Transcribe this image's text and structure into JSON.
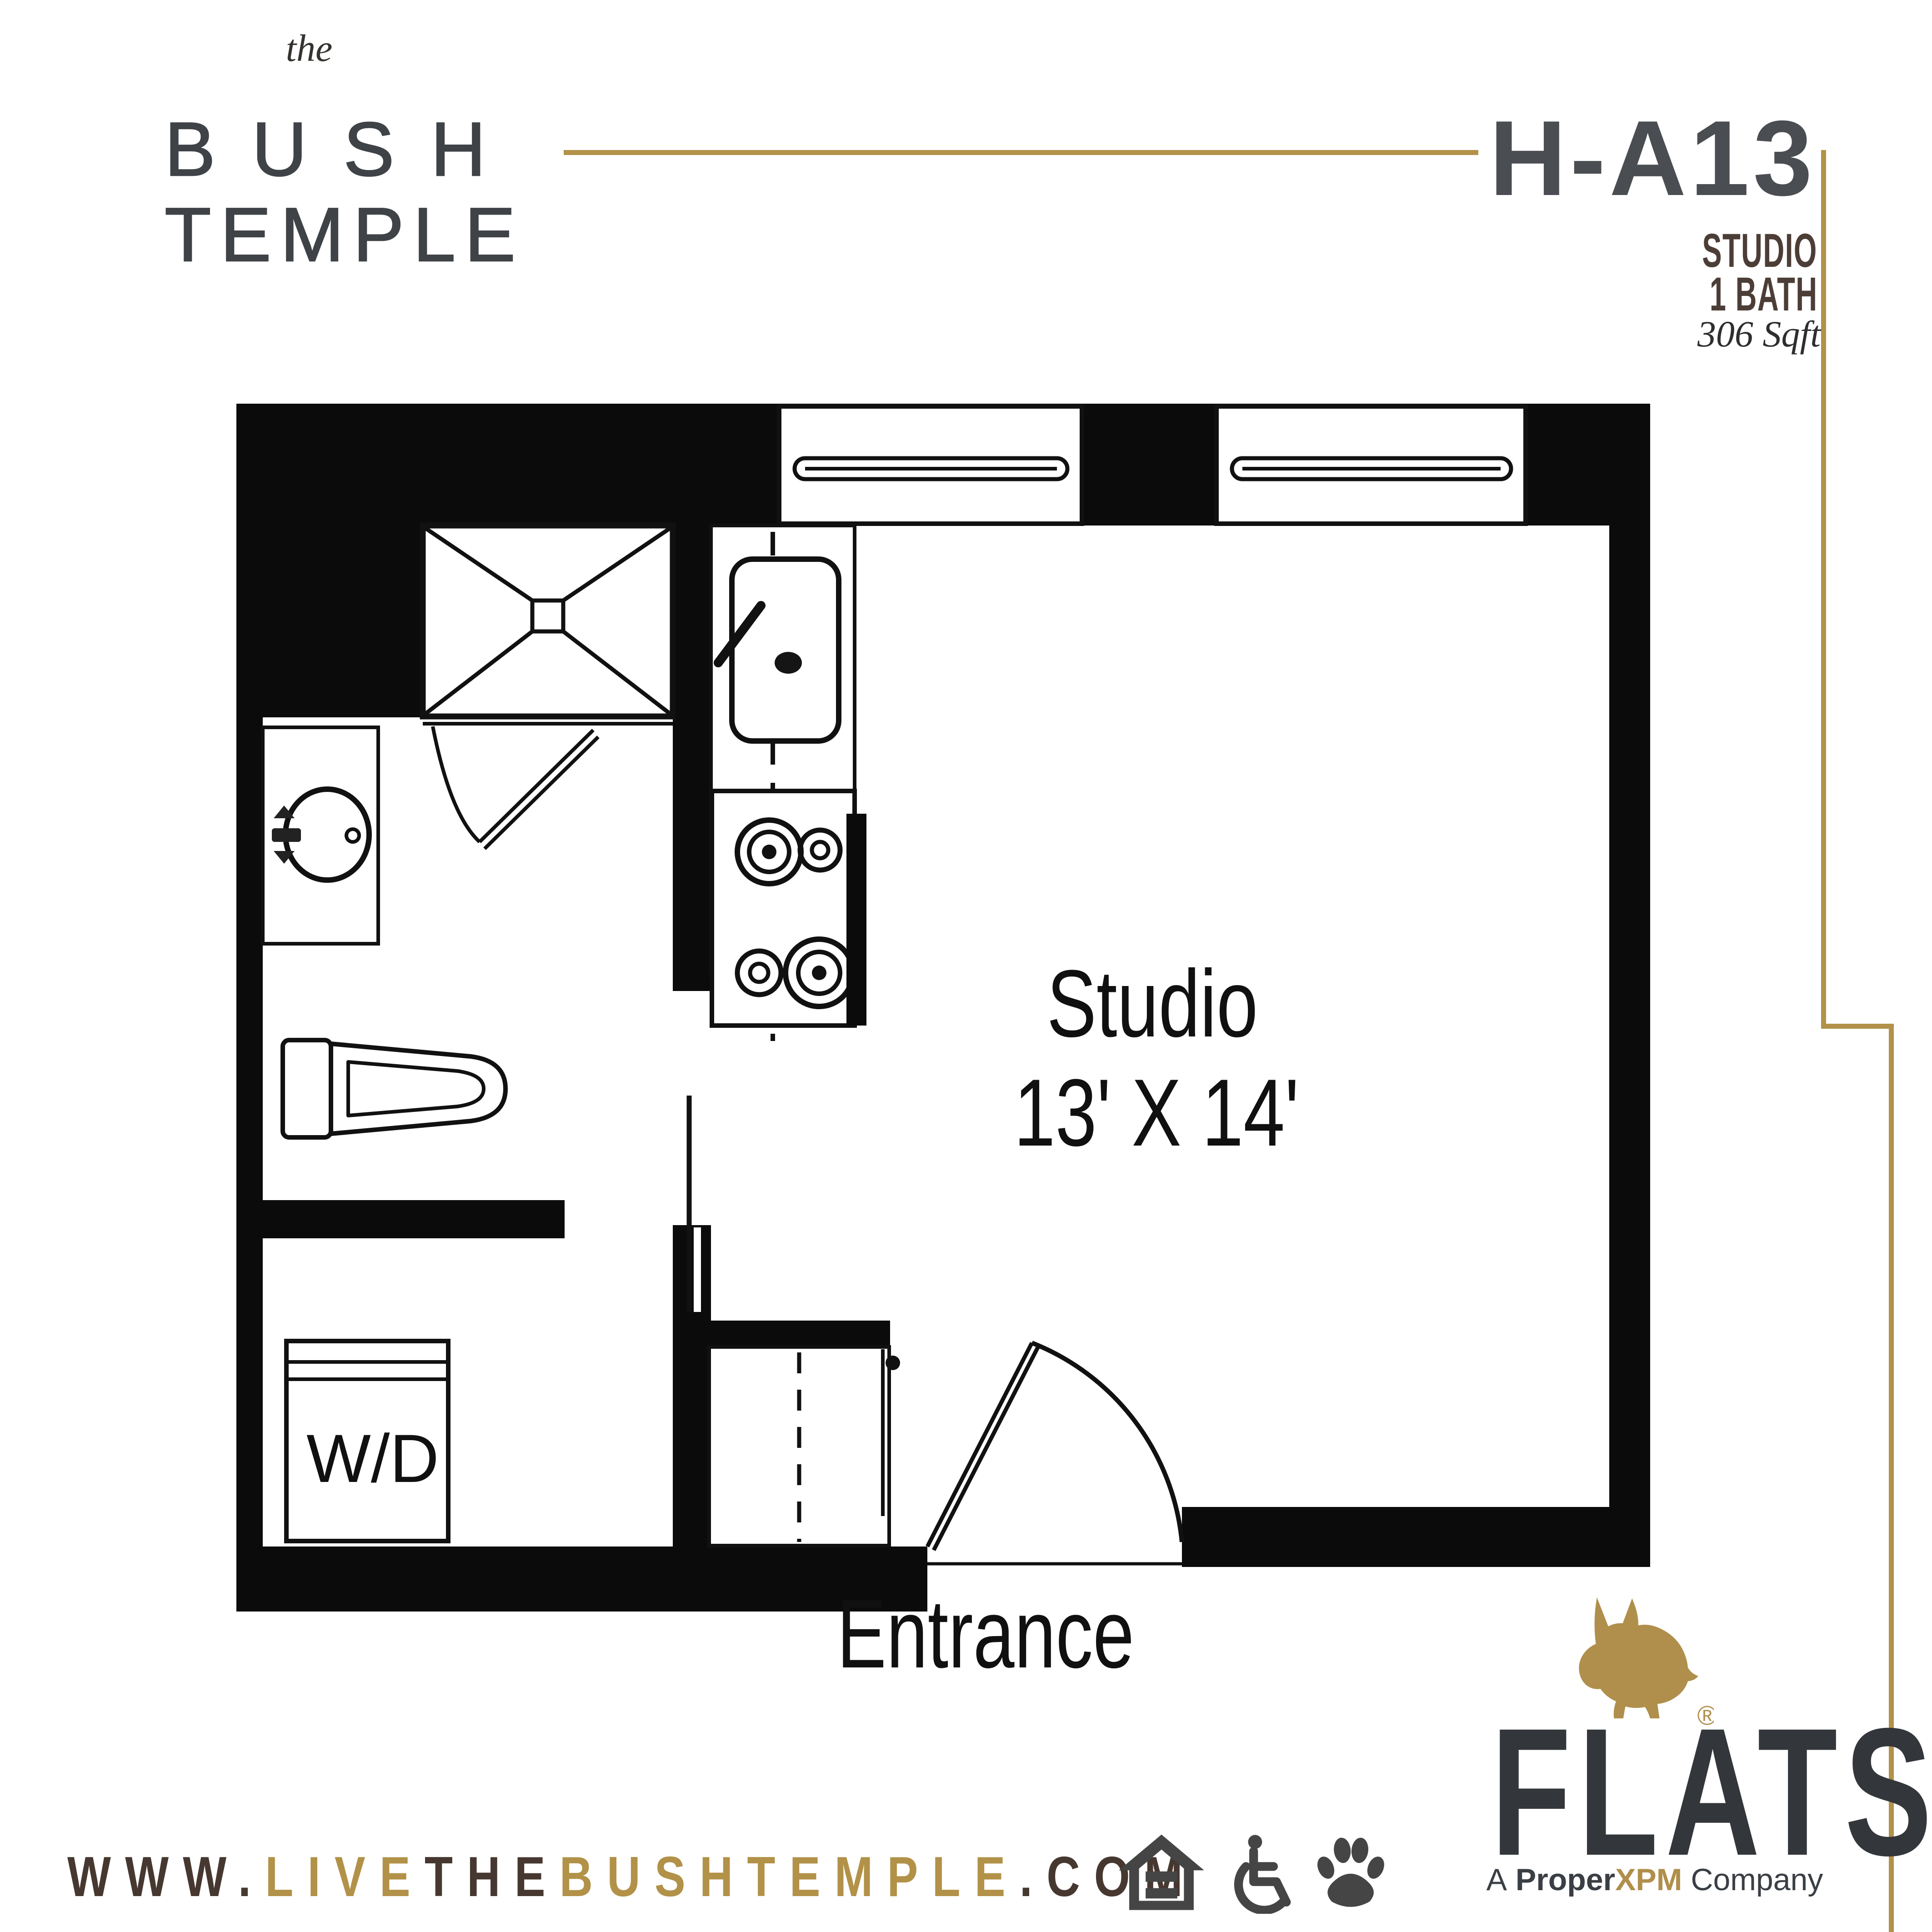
{
  "brand": {
    "the": "the",
    "bush": "BUSH",
    "temple": "TEMPLE"
  },
  "unit": {
    "code": "H-A13",
    "type": "STUDIO",
    "bath": "1 BATH",
    "area": "306 Sqft"
  },
  "floorplan": {
    "room": "Studio",
    "dims": "13' X 14'",
    "wd": "W/D",
    "entrance": "Entrance"
  },
  "website": {
    "www": "WWW.",
    "live": "LIVE",
    "the": "THE",
    "bushtemple": "BUSHTEMPLE",
    "com": ".COM"
  },
  "flats": {
    "name": "FLATS",
    "reg": "®",
    "tag_a": "A ",
    "tag_proper": "Proper",
    "tag_xpm": "XPM",
    "tag_company": " Company"
  },
  "icons": [
    "equal-housing-icon",
    "wheelchair-icon",
    "paw-icon"
  ],
  "colors": {
    "gold": "#b29148",
    "dark_brown": "#463830",
    "title_gray": "#3f4347",
    "unit_brown": "#4c3e37",
    "icon_gray": "#454545",
    "plan_black": "#0b0b0b",
    "flats_dark": "#33363a",
    "flats_gold": "#b08f4c"
  }
}
